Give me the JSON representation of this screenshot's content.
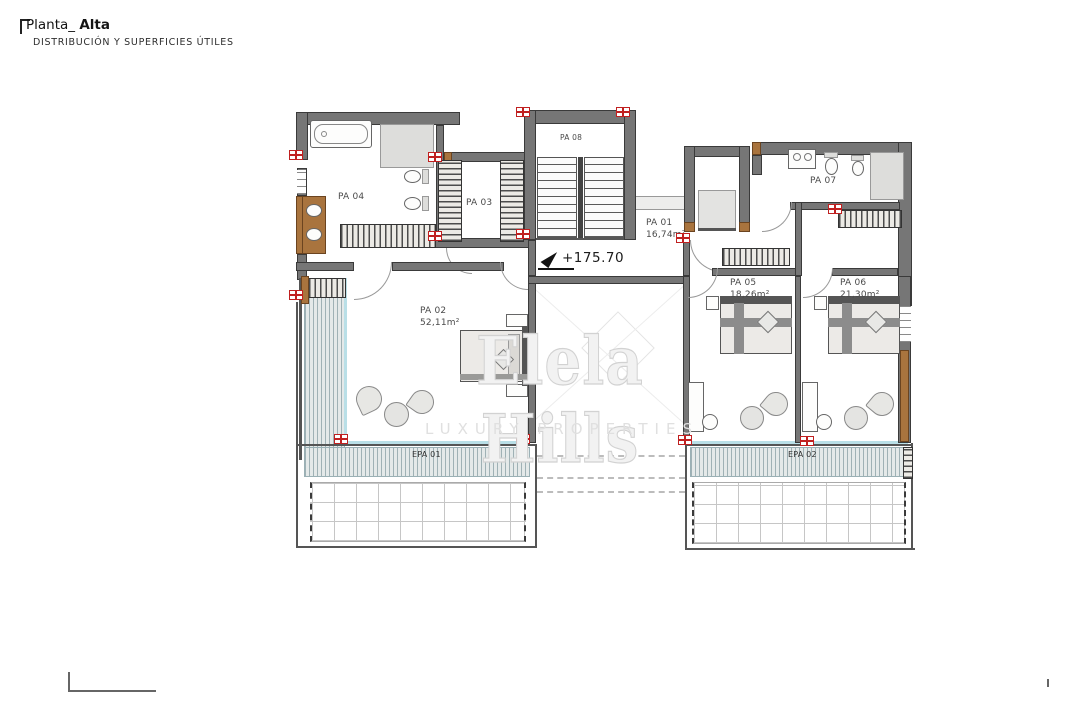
{
  "header": {
    "title_prefix": "Planta_",
    "title_emphasis": "Alta",
    "subtitle": "DISTRIBUCIÓN Y SUPERFICIES ÚTILES"
  },
  "level_marker": "+175.70",
  "rooms": {
    "pa01": {
      "label": "PA 01",
      "area": "16,74m²"
    },
    "pa02": {
      "label": "PA 02",
      "area": "52,11m²"
    },
    "pa03": {
      "label": "PA 03"
    },
    "pa04": {
      "label": "PA 04"
    },
    "pa05": {
      "label": "PA 05",
      "area": "18,26m²"
    },
    "pa06": {
      "label": "PA 06",
      "area": "21,30m²"
    },
    "pa07": {
      "label": "PA 07"
    },
    "pa08": {
      "label": "PA 08"
    }
  },
  "exterior": {
    "epa01": {
      "label": "EPA 01"
    },
    "epa02": {
      "label": "EPA 02"
    }
  },
  "watermark": {
    "name": "Elela Hills",
    "tagline": "LUXURY PROPERTIES"
  },
  "colors": {
    "wall": "#767676",
    "wood": "#a9743e",
    "registration_mark": "#c02020",
    "glazing": "#b9dfe7",
    "furniture_fill": "#e6e4e1",
    "deck_stripe": "#9fb1b5"
  }
}
